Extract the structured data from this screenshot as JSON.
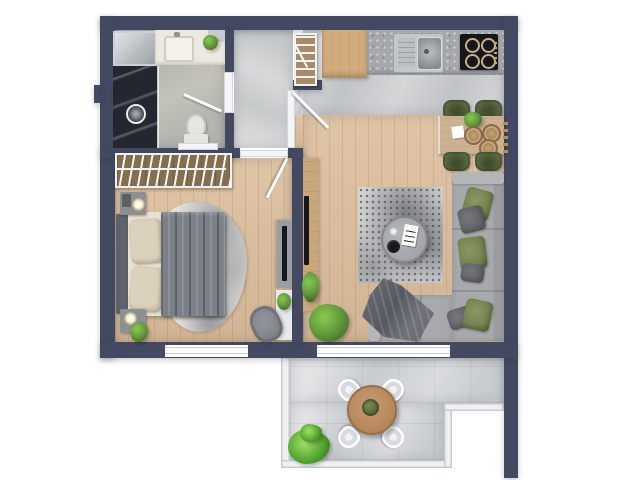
{
  "scene": {
    "description": "Top-down 3D rendered floor plan of a one-bedroom apartment with balcony",
    "text_labels": []
  },
  "rooms": [
    {
      "id": "bathroom",
      "fixtures": [
        "vanity-with-sink",
        "vanity-plant",
        "walk-in-shower",
        "shower-head",
        "toilet",
        "glass-shaft",
        "swing-door"
      ]
    },
    {
      "id": "entry-hall",
      "fixtures": [
        "slatted-radiator-shelf",
        "entry-swing-door"
      ]
    },
    {
      "id": "bedroom",
      "fixtures": [
        "open-wardrobe-with-hangers",
        "double-bed",
        "headboard",
        "bed-pillows",
        "duvet",
        "cowhide-rug",
        "nightstand-with-lamp",
        "nightstand-with-lamp-and-plant",
        "media-sideboard-with-tv",
        "white-side-table-with-plant",
        "armchair",
        "window",
        "swing-door"
      ]
    },
    {
      "id": "kitchen-living-room",
      "fixtures": [
        "corner-cabinet",
        "kitchen-counter",
        "stainless-sink",
        "four-burner-cooktop",
        "dining-table",
        "woven-place-settings",
        "table-plant",
        "four-green-dining-chairs",
        "wall-peg-strip",
        "tv-console-with-tv",
        "console-plant",
        "area-rug",
        "round-coffee-table",
        "magazine",
        "black-bowl",
        "l-shaped-sofa",
        "green-and-gray-pillows",
        "throw-blanket",
        "floor-plant",
        "balcony-door"
      ]
    },
    {
      "id": "balcony",
      "fixtures": [
        "round-bistro-table",
        "table-centerpiece",
        "four-white-chairs",
        "potted-plant",
        "railing"
      ]
    }
  ],
  "colors": {
    "wall": "#424960",
    "woodFloor": "#dcbe9c",
    "tileKitchen": "#c1c4c6",
    "tileHall": "#c7cacb",
    "tileBath": "#b3b5b0",
    "tileBalcony": "#c8cccf",
    "counter": "#a5a9ad",
    "cabinetWood": "#d2ab7d",
    "tableWood": "#cdb292",
    "chairGreen": "#5c6b44",
    "sofa": "#a7a9ac",
    "sofaLight": "#b3b5b8",
    "pillowGreen": "#74834f",
    "pillowGray": "#5f6166",
    "blanket": "#63666c",
    "rugBase": "#d5d7d9",
    "rugDark": "#74777b",
    "coffeeTable": "#a2a6aa",
    "consoleWood": "#c9a77b",
    "tvBlack": "#15171b",
    "wardrobeWood": "#84704f",
    "bedSheet": "#e8e1d0",
    "bedPillow": "#dbd1bc",
    "duvet": "#7b7f88",
    "headboard": "#5f626b",
    "nightstand": "#8d8f92",
    "cowhide": "#ebe9e4",
    "armchairGray": "#7b7e85",
    "sideTableWhite": "#e8e9eb",
    "vanity": "#ece9e1",
    "showerDark": "#23272f",
    "toiletWhite": "#e6e6e0",
    "radiatorWood": "#a98a66",
    "plantDark": "#3f6524",
    "plantMid": "#61953a",
    "plantLight": "#82c24f",
    "terracePlant": "#55a62f",
    "terraceTable": "#b9885f",
    "terraceChair": "#f2f3f4",
    "railing": "#eef0f2",
    "thresholdWhite": "#f4f5f6",
    "shaftGlassLight": "#e2e5e7",
    "shaftGlassDark": "#9aa0a6",
    "lampGlow": "#fff3d2"
  }
}
